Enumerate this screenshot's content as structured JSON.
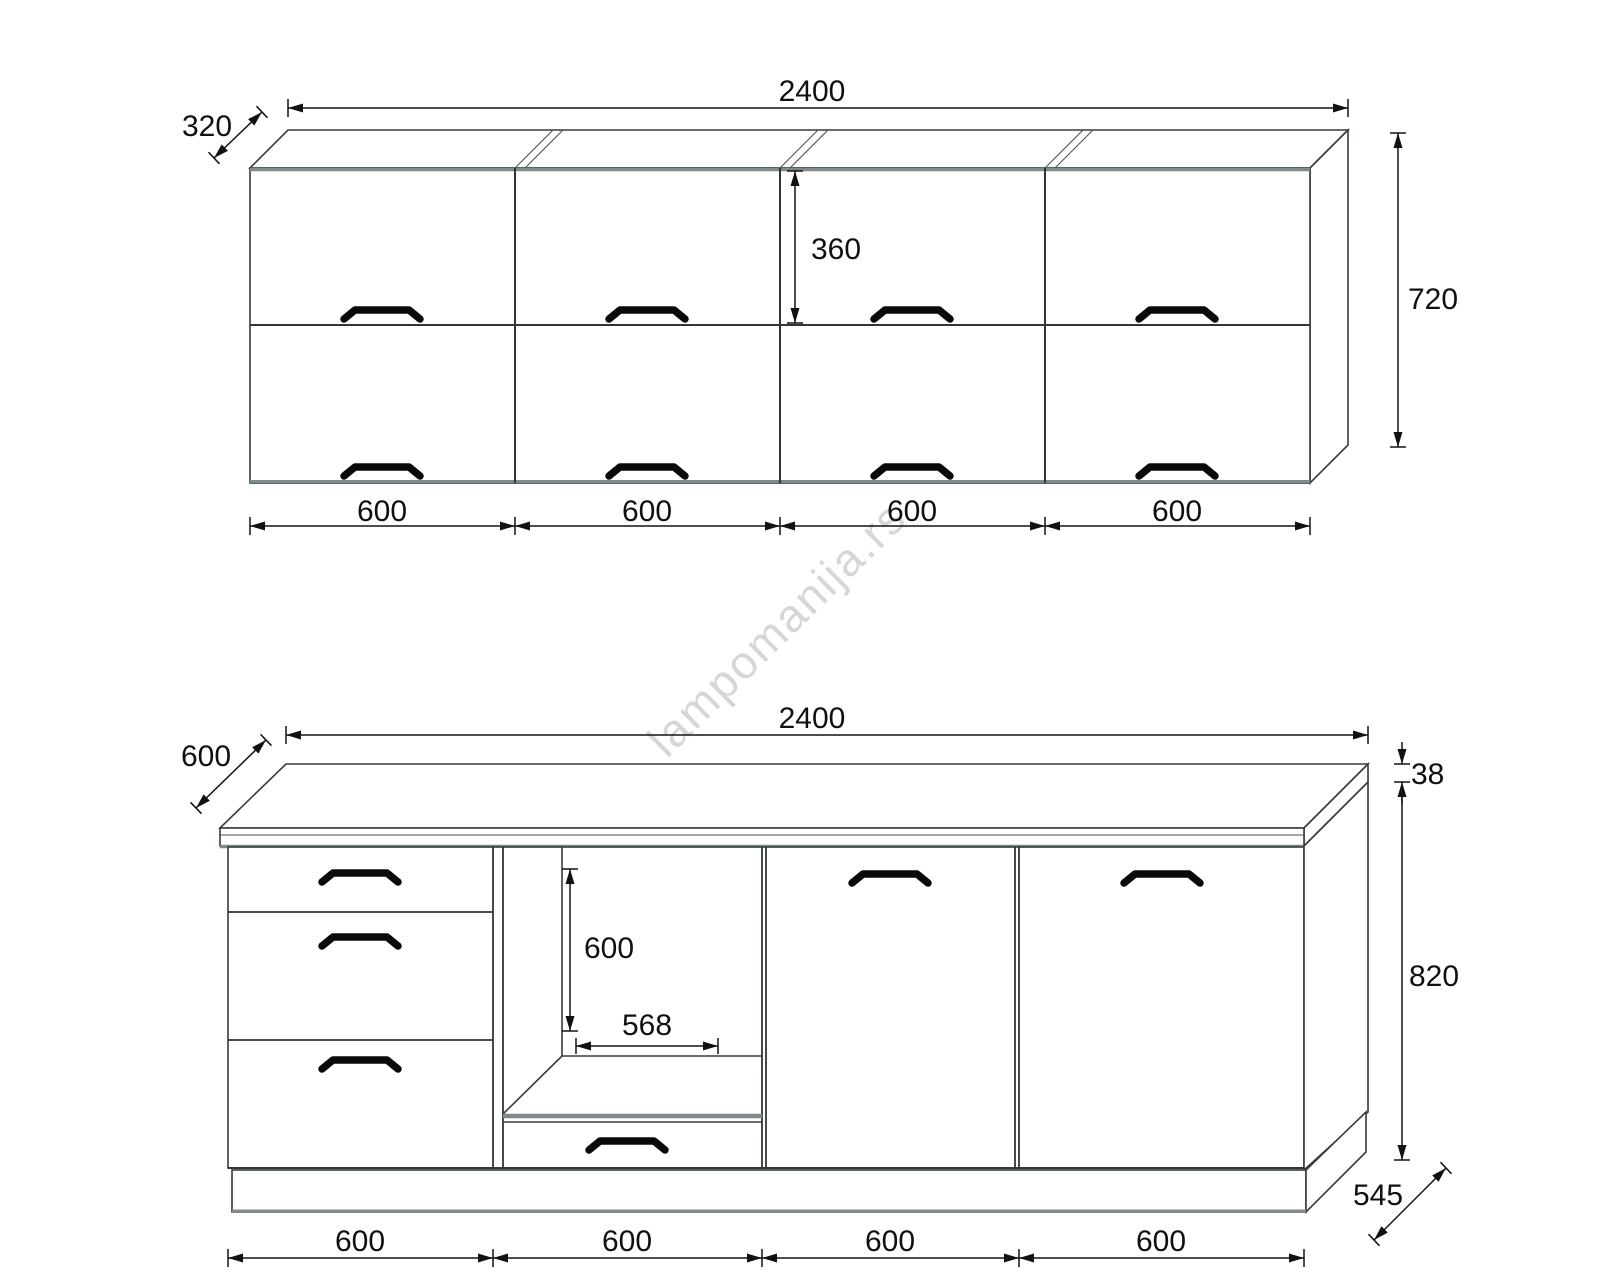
{
  "watermark": {
    "text": "lampomanija.rs"
  },
  "wall_cabinet": {
    "width_label": "2400",
    "depth_label": "320",
    "height_label": "720",
    "upper_door_height_label": "360",
    "section_widths": [
      "600",
      "600",
      "600",
      "600"
    ]
  },
  "base_cabinet": {
    "width_label": "2400",
    "depth_label": "600",
    "worktop_thickness_label": "38",
    "height_label": "820",
    "base_depth_label": "545",
    "oven_opening_height_label": "600",
    "oven_opening_width_label": "568",
    "section_widths": [
      "600",
      "600",
      "600",
      "600"
    ]
  }
}
